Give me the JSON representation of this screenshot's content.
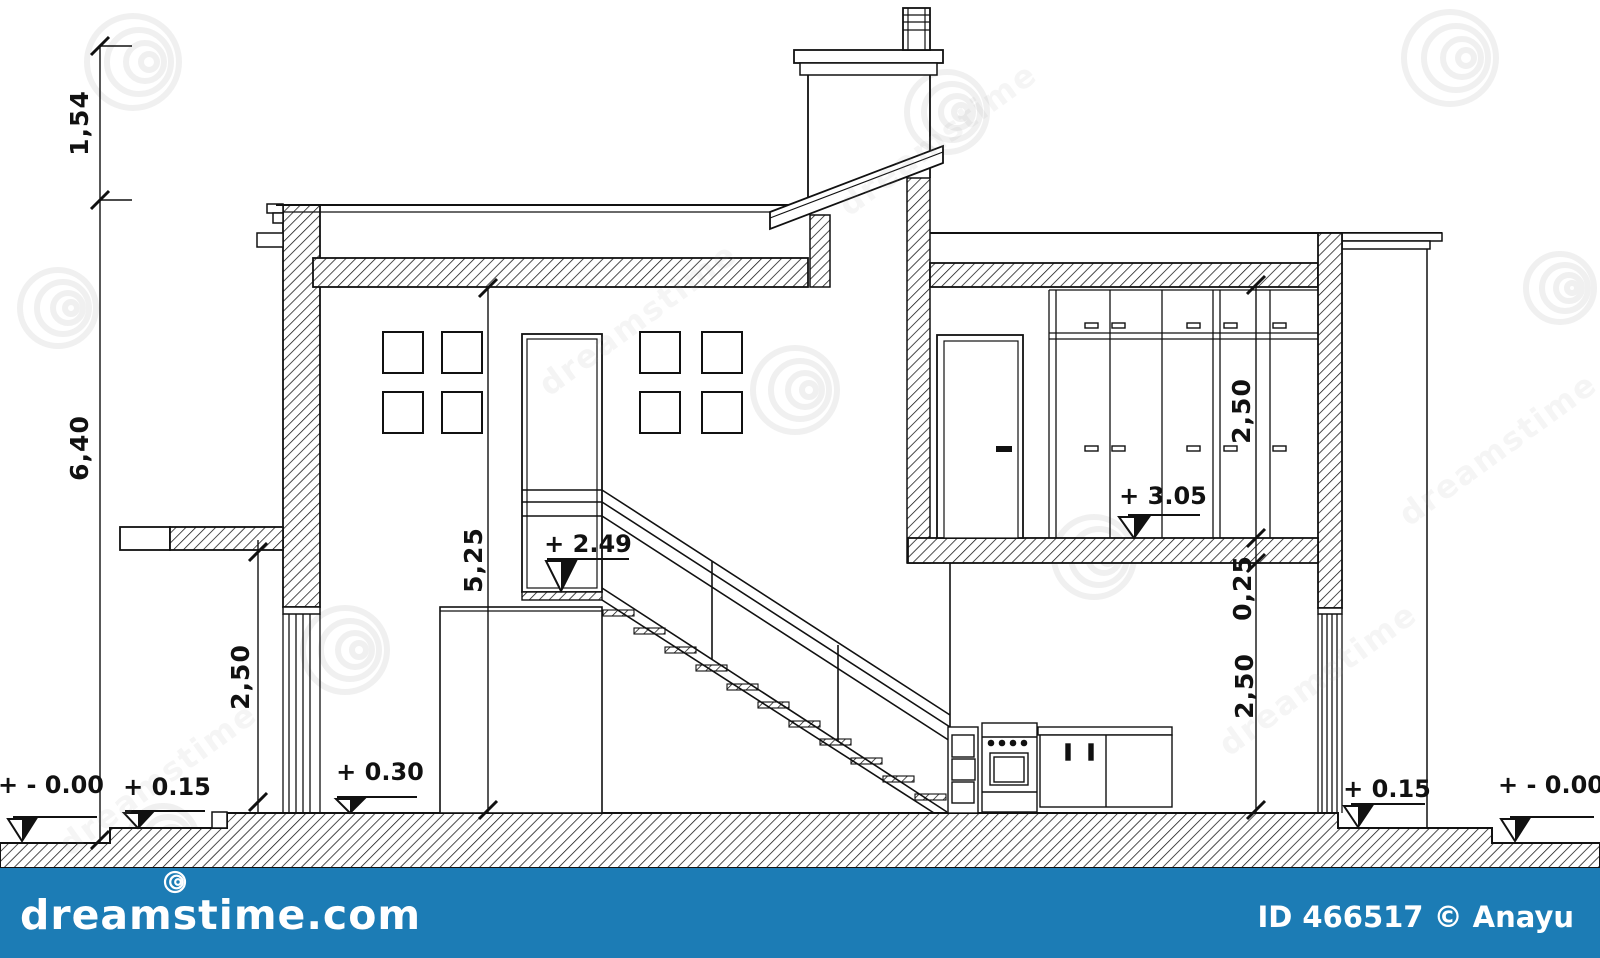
{
  "drawing": {
    "title": "house cross-section technical drawing",
    "dims": {
      "chimney": "1,54",
      "total_left": "6,40",
      "lower_left": "2,50",
      "stairwell": "5,25",
      "upper_right": "2,50",
      "slab_right": "0,25",
      "lower_right": "2,50"
    },
    "levels": {
      "ground_left": "+ - 0.00",
      "step_left": "+ 0.15",
      "ground_floor": "+ 0.30",
      "landing": "+ 2.49",
      "upper_floor": "+ 3.05",
      "plinth_right": "+ 0.15",
      "ground_right": "+ - 0.00"
    }
  },
  "watermark": {
    "brand": "dreamstime",
    "site": "dreamstime.com",
    "credit": "ID 466517 © Anayu",
    "bar_color": "#1c7cb5"
  },
  "colors": {
    "line": "#111111",
    "background": "#ffffff"
  }
}
